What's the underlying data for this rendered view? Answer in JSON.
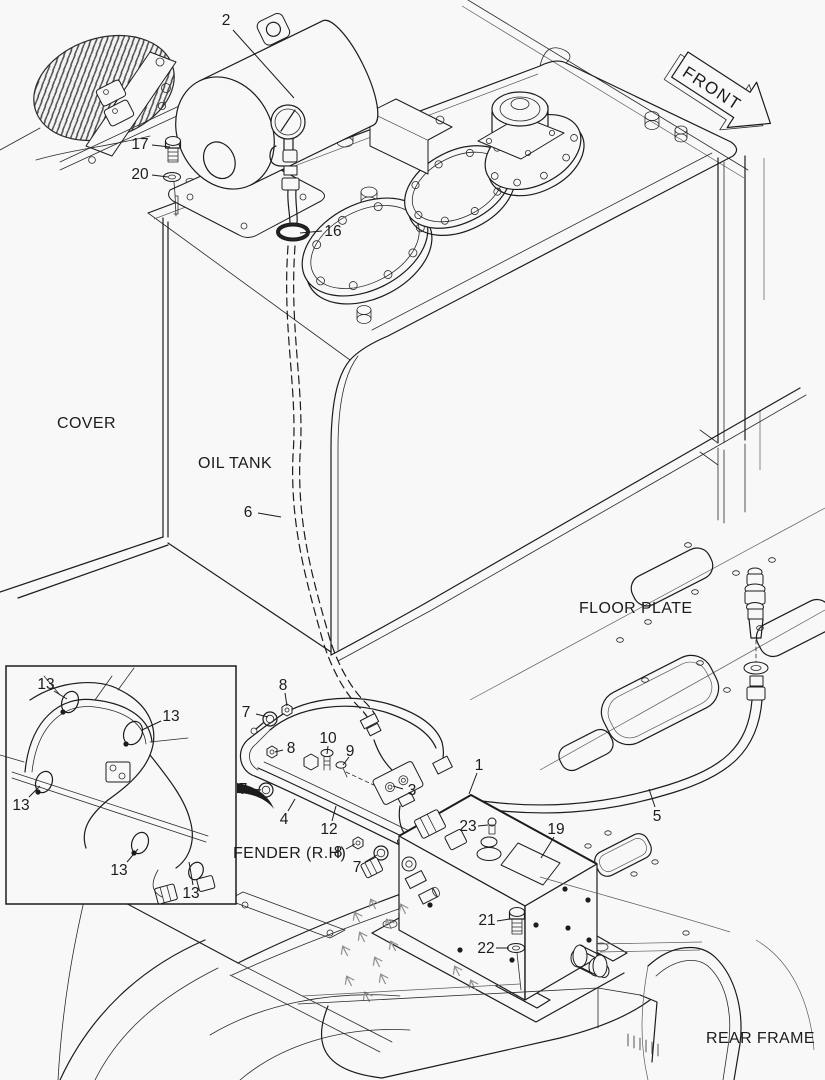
{
  "figure": {
    "description": "Exploded parts diagram - oil tank, fender piping and control box on rear frame",
    "background": "#f8f8f8",
    "line_color": "#1c1c1c",
    "area_labels": {
      "cover": "COVER",
      "oil_tank": "OIL TANK",
      "floor_plate": "FLOOR PLATE",
      "fender_rh": "FENDER (R.H)",
      "rear_frame": "REAR FRAME",
      "front": "FRONT"
    },
    "callouts": [
      {
        "n": "2"
      },
      {
        "n": "17"
      },
      {
        "n": "20"
      },
      {
        "n": "16"
      },
      {
        "n": "6"
      },
      {
        "n": "13"
      },
      {
        "n": "13"
      },
      {
        "n": "13"
      },
      {
        "n": "13"
      },
      {
        "n": "13"
      },
      {
        "n": "8"
      },
      {
        "n": "7"
      },
      {
        "n": "8"
      },
      {
        "n": "10"
      },
      {
        "n": "9"
      },
      {
        "n": "3"
      },
      {
        "n": "7"
      },
      {
        "n": "4"
      },
      {
        "n": "12"
      },
      {
        "n": "8"
      },
      {
        "n": "7"
      },
      {
        "n": "1"
      },
      {
        "n": "23"
      },
      {
        "n": "19"
      },
      {
        "n": "5"
      },
      {
        "n": "21"
      },
      {
        "n": "22"
      }
    ]
  }
}
